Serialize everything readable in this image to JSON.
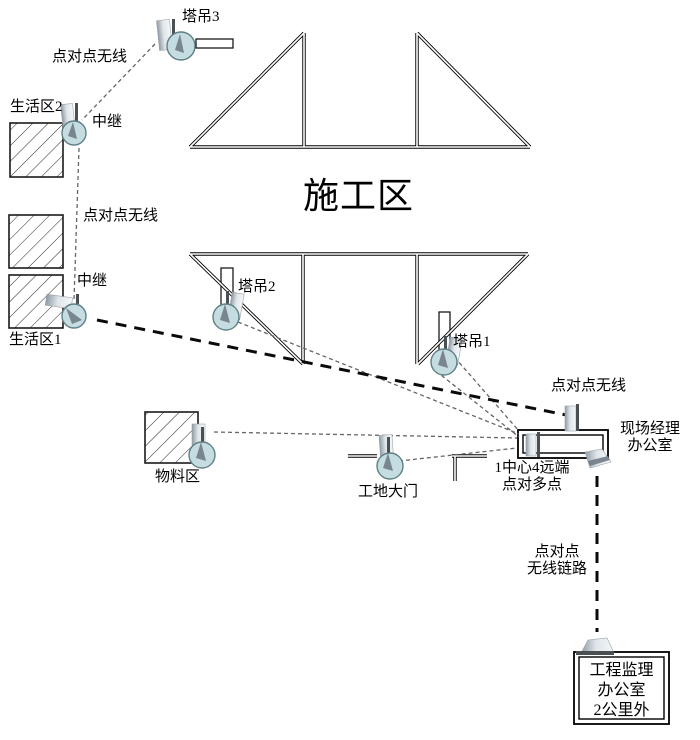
{
  "diagram": {
    "title": "施工区无线网络拓扑示意图",
    "labels": {
      "crane3": "塔吊3",
      "p2p_top": "点对点无线",
      "living2": "生活区2",
      "relay1": "中继",
      "p2p_mid": "点对点无线",
      "relay2": "中继",
      "living1": "生活区1",
      "construction_zone": "施工区",
      "crane2": "塔吊2",
      "crane1": "塔吊1",
      "p2p_right": "点对点无线",
      "manager_office_line1": "现场经理",
      "manager_office_line2": "办公室",
      "materials": "物料区",
      "gate": "工地大门",
      "hub_line1": "1中心4远端",
      "hub_line2": "点对多点",
      "p2p_link_line1": "点对点",
      "p2p_link_line2": "无线链路",
      "supervision_line1": "工程监理",
      "supervision_line2": "办公室",
      "supervision_line3": "2公里外"
    },
    "colors": {
      "radio_fill": "#c5dde1",
      "radio_stroke": "#5e7f86",
      "line": "#0a0a0a",
      "thin_link": "#666666"
    },
    "connections": [
      {
        "from": "塔吊3",
        "to": "中继(生活区2)",
        "type": "点对点无线"
      },
      {
        "from": "中继(生活区2)",
        "to": "中继(生活区1)",
        "type": "点对点无线"
      },
      {
        "from": "中继(生活区1)",
        "to": "现场经理办公室",
        "type": "点对点无线"
      },
      {
        "from": "塔吊2",
        "to": "现场经理办公室",
        "type": "1中心4远端 点对多点"
      },
      {
        "from": "塔吊1",
        "to": "现场经理办公室",
        "type": "1中心4远端 点对多点"
      },
      {
        "from": "物料区",
        "to": "现场经理办公室",
        "type": "1中心4远端 点对多点"
      },
      {
        "from": "工地大门",
        "to": "现场经理办公室",
        "type": "1中心4远端 点对多点"
      },
      {
        "from": "现场经理办公室",
        "to": "工程监理办公室(2公里外)",
        "type": "点对点无线链路"
      }
    ]
  }
}
